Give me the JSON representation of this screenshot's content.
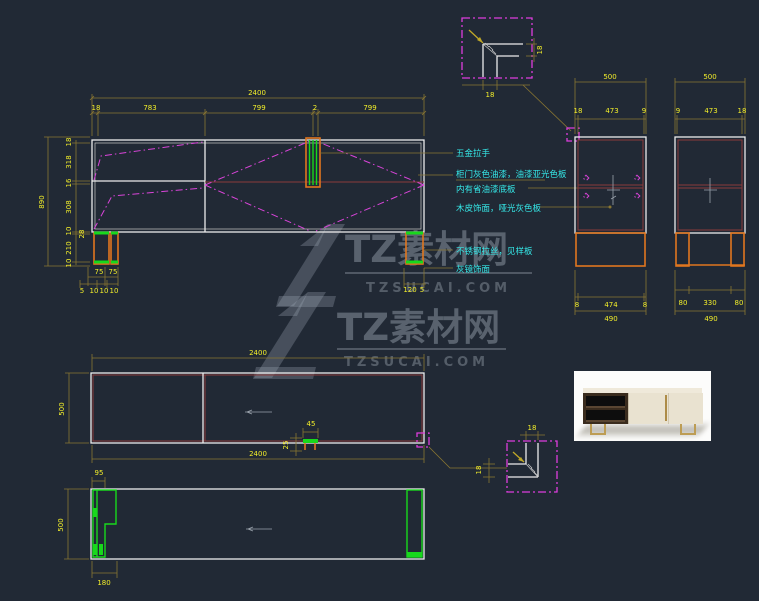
{
  "palette": {
    "background": "#212935",
    "dim_line": "#8a7632",
    "dim_text": "#f2ee2a",
    "outline_white": "#ececec",
    "magenta": "#dd3ddd",
    "orange": "#e0761f",
    "green": "#18d81c",
    "dark_red": "#8a3a3a",
    "annotation_cyan": "#35e8e8",
    "watermark_gray": "#a8b2be"
  },
  "watermark": {
    "brand": "TZ素材网",
    "domain": "TZSUCAI.COM"
  },
  "front": {
    "dim_overall_w": "2400",
    "dim_segments": [
      "18",
      "783",
      "799",
      "2",
      "799"
    ],
    "dim_overall_h": "890",
    "dim_v_segments": [
      "18",
      "318",
      "16",
      "308",
      "10",
      "210",
      "10"
    ],
    "dim_v_extra": "28",
    "leg_left_row1": [
      "75",
      "75"
    ],
    "leg_left_row2": [
      "5",
      "10",
      "10",
      "10"
    ],
    "leg_right": [
      "120",
      "5"
    ],
    "annotations": [
      "五金拉手",
      "柜门灰色油漆，油漆亚光色板",
      "内有省油漆底板",
      "木皮饰面，哑光灰色板",
      "不锈钢拉丝，见样板",
      "灰镜饰面"
    ]
  },
  "detail_top": {
    "dim_w": "18",
    "dim_h": "18"
  },
  "side1": {
    "dim_top": "500",
    "row": [
      "18",
      "473",
      "9"
    ],
    "bottom": [
      "8",
      "474",
      "8"
    ],
    "overall": "490"
  },
  "side2": {
    "dim_top": "500",
    "row": [
      "9",
      "473",
      "18"
    ],
    "bottom": [
      "80",
      "330",
      "80"
    ],
    "overall": "490"
  },
  "plan": {
    "dim_top": "2400",
    "dim_bottom": "2400",
    "dim_left": "500",
    "handle_w": "45",
    "handle_off": "25"
  },
  "detail_bottom": {
    "dim_w": "18",
    "dim_h": "18"
  },
  "base": {
    "dim_top": "95",
    "dim_bottom": "180",
    "dim_left": "500"
  }
}
